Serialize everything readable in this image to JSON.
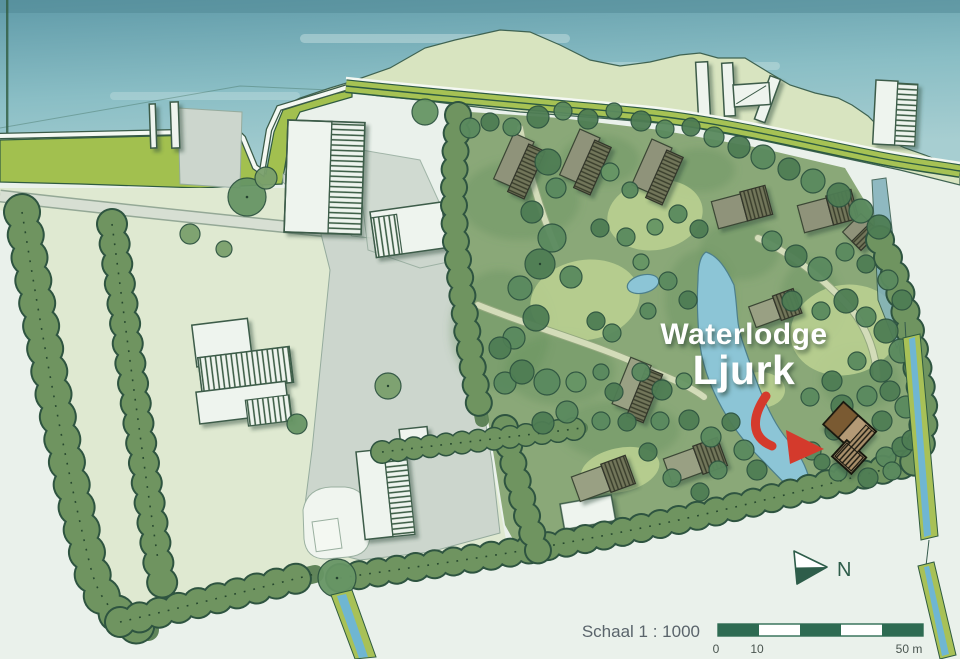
{
  "title": {
    "line1": "Waterlodge",
    "line2": "Ljurk"
  },
  "north": {
    "label": "N"
  },
  "scale_bar": {
    "label": "Schaal 1 : 1000",
    "ticks": [
      "0",
      "10",
      "50 m"
    ]
  },
  "colors": {
    "bg": "#eaf1eb",
    "water_top": "#56929f",
    "water_mid": "#7fb4bd",
    "water_low": "#a9cfd1",
    "water_streak": "#cfe5e4",
    "dike_green": "#a2c04f",
    "road_green": "#a6c254",
    "road_dark": "#2c5a42",
    "quay": "#f4f8f2",
    "foreshore": "#d8e4c0",
    "field": "#dfe9d1",
    "yard": "#ccd6cd",
    "yard_line": "#95ab9d",
    "park": "#8aa878",
    "park_dark": "#5e8b58",
    "meadow": "#b9cf90",
    "hedge_mid": "#6f9460",
    "hedge_band": "#587e52",
    "tree_stroke": "#2e5440",
    "bld_white": "#eef4ee",
    "bld_line": "#3c5c49",
    "lodge_plain": "#8f937a",
    "lodge_plain2": "#99a083",
    "lodge_hatch_bg": "#73775b",
    "lodge_hatch_line": "#383c2b",
    "pond": "#8cc5d6",
    "pond_line": "#4d7f8a",
    "canal_water": "#6fb6d2",
    "canal_bank": "#a8c157",
    "ditch": "#7fb0ba",
    "hl_tan": "#b49a76",
    "hl_brown": "#7a5a33",
    "hl_line": "#15150f",
    "arrow_red": "#d43a2c",
    "title": "#ffffff",
    "scale_dark": "#2e6b52",
    "scale_text": "#5a646b",
    "tick_text": "#4a5550",
    "north": "#2e5d4a"
  }
}
